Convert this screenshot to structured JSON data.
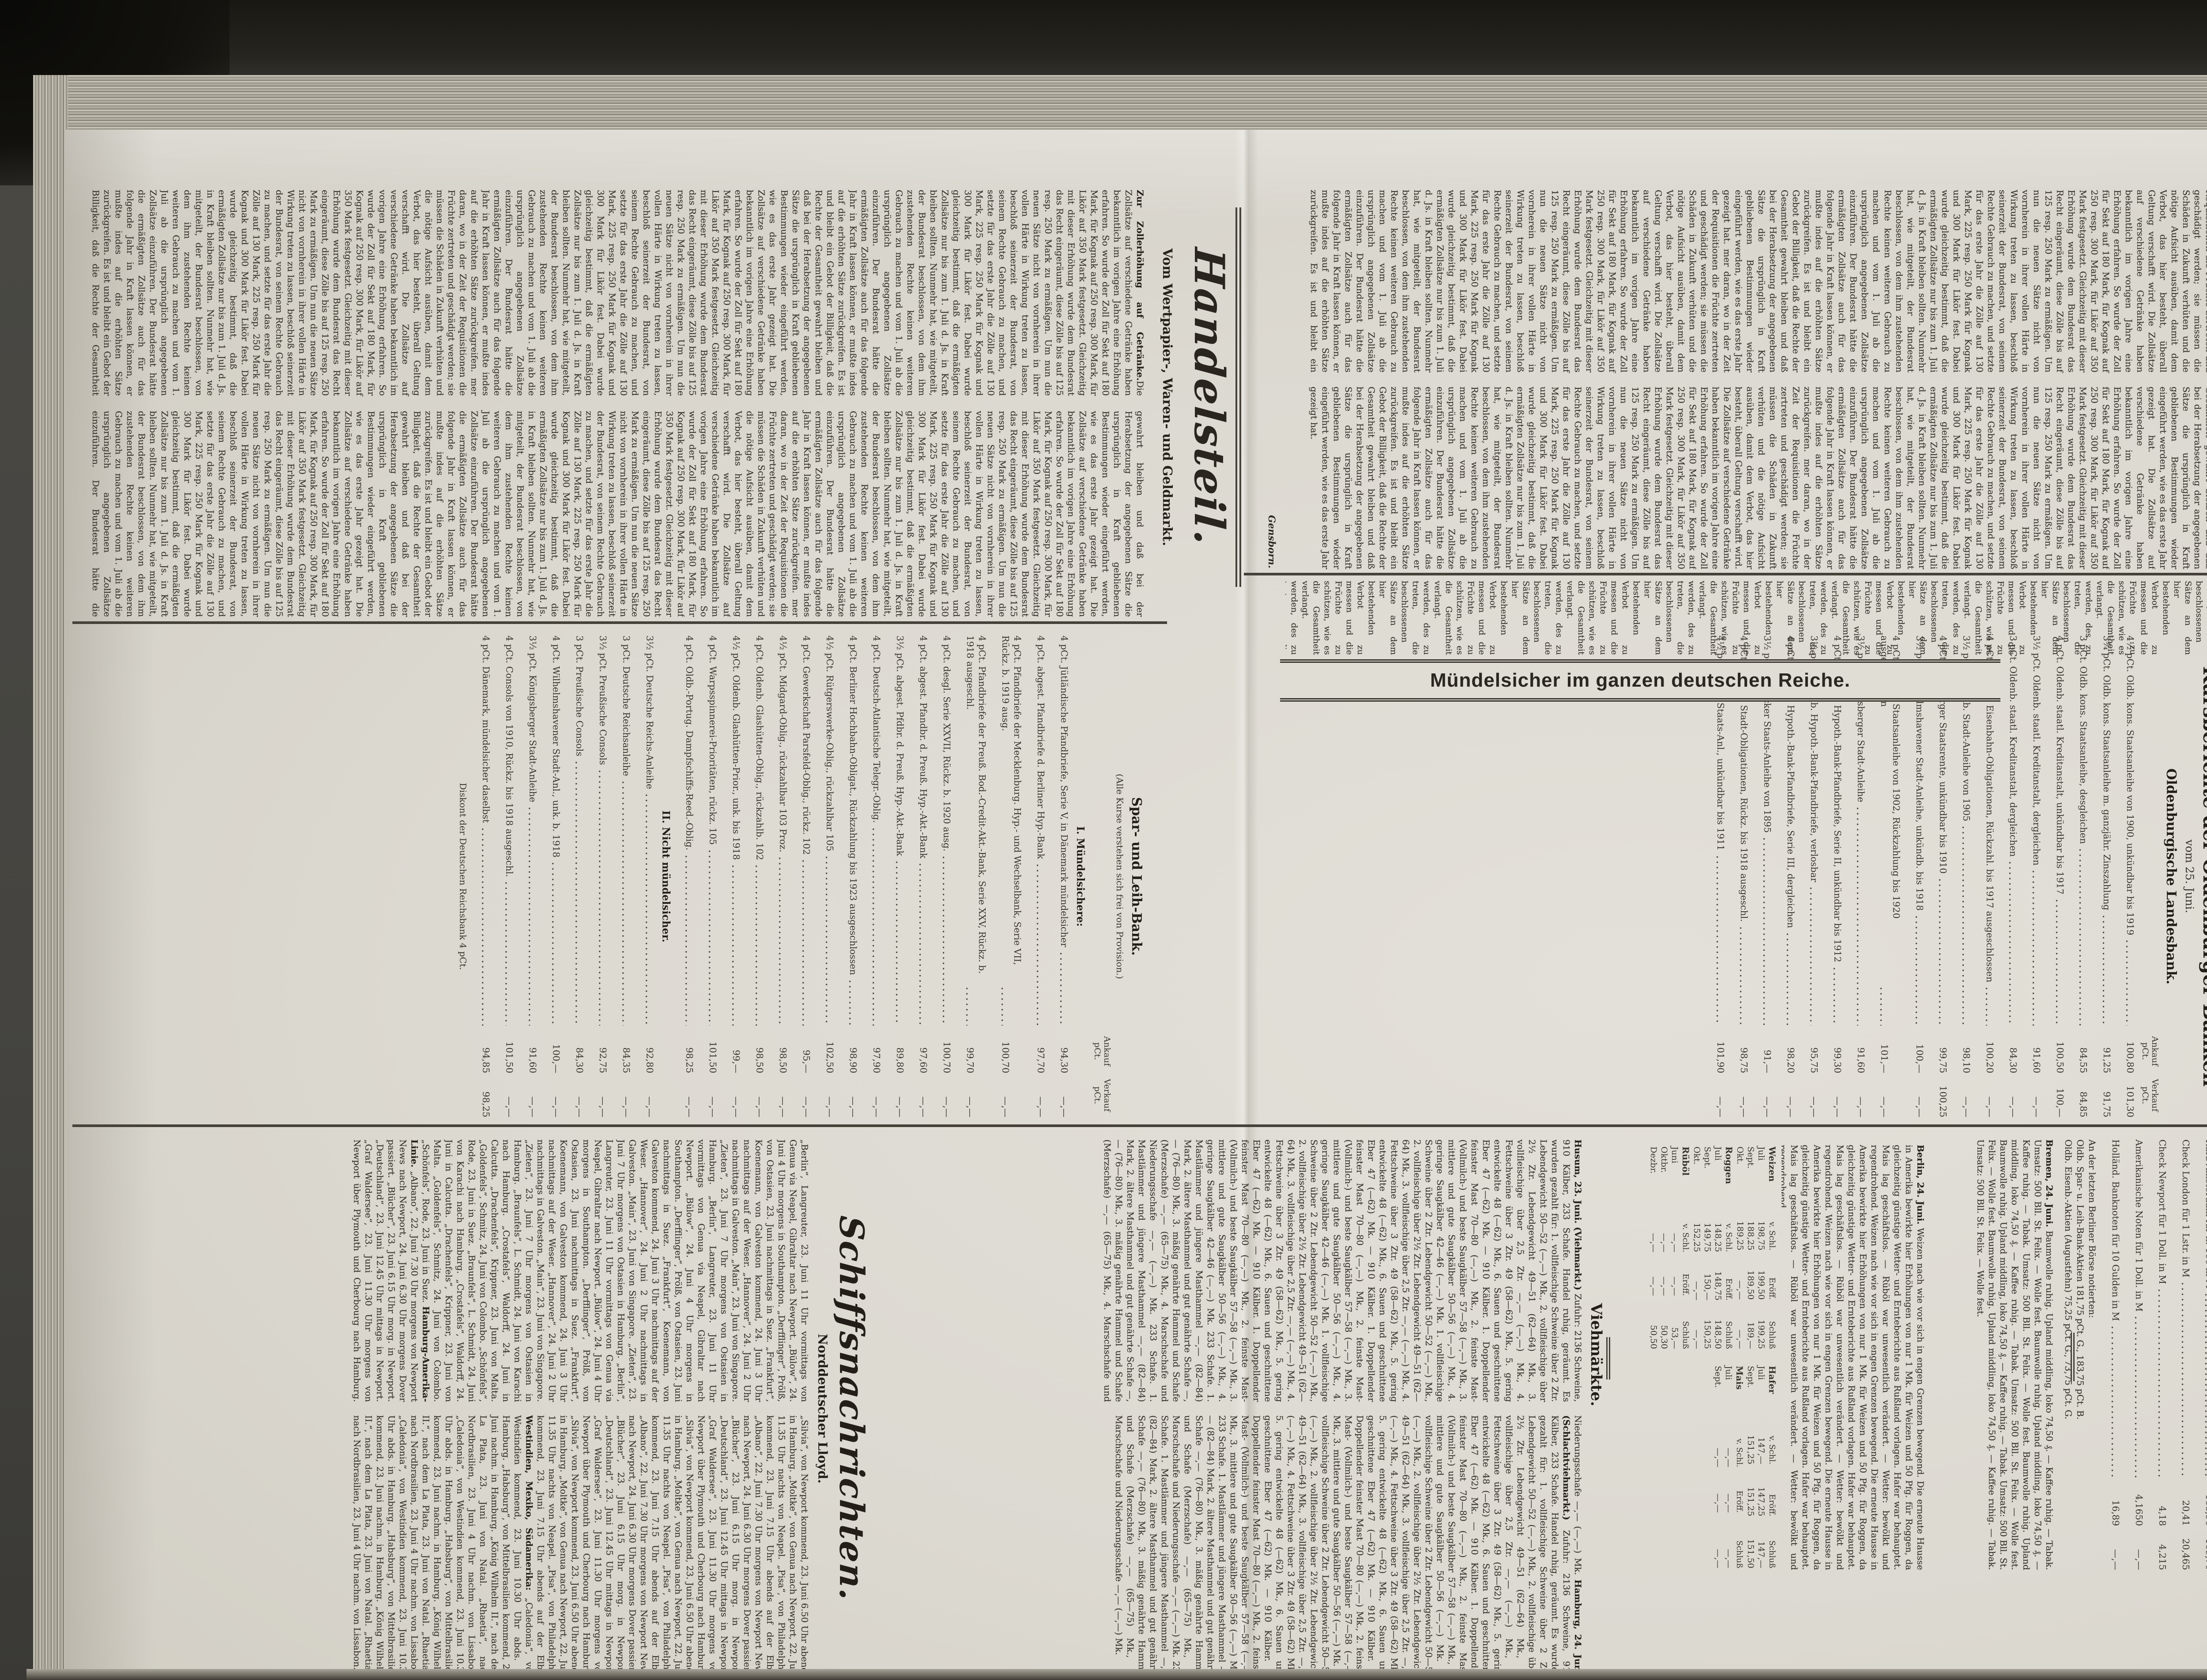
{
  "page": {
    "number_stamp": "1244"
  },
  "colors": {
    "paper": "#dcd9d1",
    "ink": "#39342c",
    "ink_bold": "#262119",
    "rule": "#46423a",
    "bg_dark": "#26251f"
  },
  "fill": {
    "req": "mer daran, wo in der Zeit der Requisitionen die Früchte zertreten und geschädigt werden; sie müssen die Schäden in Zukunft verhüten und die nötige Aufsicht ausüben, damit dem Verbot, das hier besteht, überall Geltung verschafft wird. ",
    "tariff": "Die Zollsätze auf verschiedene Getränke haben bekanntlich im vorigen Jahre eine Erhöhung erfahren. So wurde der Zoll für Sekt auf 180 Mark, für Kognak auf 250 resp. 300 Mark, für Likör auf 350 Mark festgesetzt. Gleichzeitig mit dieser Erhöhung wurde dem Bundesrat das Recht eingeräumt, diese Zölle bis auf 125 resp. 250 Mark zu ermäßigen. Um nun die neuen Sätze nicht von vornherein in ihrer vollen Härte in Wirkung treten zu lassen, beschloß seinerzeit der Bundesrat, von seinem Rechte Gebrauch zu machen, und setzte für das erste Jahr die Zölle auf 130 Mark, 225 resp. 250 Mark für Kognak und 300 Mark für Likör fest. Dabei wurde gleichzeitig bestimmt, daß die ermäßigten Zollsätze nur bis zum 1. Juli d. Js. in Kraft bleiben sollten. Nunmehr hat, wie mitgeteilt, der Bundesrat beschlossen, von dem ihm zustehenden Rechte keinen weiteren Gebrauch zu machen und vom 1. Juli ab die ursprünglich angegebenen Zollsätze einzuführen. Der Bundesrat hätte die ermäßigten Zollsätze auch für das folgende Jahr in Kraft lassen können, er mußte indes auf die erhöhten Sätze zurückgreifen. ",
    "forest": "Es ist und bleibt ein Gebot der Billigkeit, daß die Rechte der Gesamtheit gewahrt bleiben und daß bei der Herabsetzung der angegebenen Sätze die ursprünglich in Kraft gebliebenen Bestimmungen wieder eingeführt werden, wie es das erste Jahr gezeigt hat. ",
    "narrow": "werden, des zu treten, die beschlossenen Sätze an dem hier bestehenden Verbot zu messen und die Früchte zu schützen, wie es die Gesamtheit verlangt. "
  },
  "news": {
    "article_end": {
      "segments": [
        {
          "ref": "fill.req"
        },
        {
          "ref": "fill.tariff"
        },
        {
          "ref": "fill.forest"
        },
        {
          "ref": "fill.req"
        },
        {
          "ref": "fill.tariff"
        },
        {
          "ref": "fill.forest"
        },
        {
          "ref": "fill.tariff"
        },
        {
          "ref": "fill.req"
        },
        {
          "ref": "fill.tariff"
        },
        {
          "ref": "fill.forest"
        }
      ],
      "signature": "Gensborn."
    },
    "narrow_col": {
      "segments": [
        {
          "ref": "fill.narrow",
          "r": 8
        }
      ]
    },
    "handelsteil": {
      "title": "Handelsteil.",
      "subtitle": "Vom Wertpapier-, Waren- und Geldmarkt.",
      "lead": "Zur Zollerhöhung auf Getränke.",
      "segments": [
        {
          "ref": "fill.tariff"
        },
        {
          "ref": "fill.forest"
        },
        {
          "ref": "fill.tariff"
        },
        {
          "ref": "fill.req"
        },
        {
          "ref": "fill.tariff"
        },
        {
          "ref": "fill.forest"
        },
        {
          "ref": "fill.tariff"
        },
        {
          "ref": "fill.req"
        },
        {
          "ref": "fill.tariff"
        },
        {
          "ref": "fill.forest"
        },
        {
          "ref": "fill.tariff"
        }
      ]
    }
  },
  "ad_banner": {
    "text": "Mündelsicher im ganzen deutschen Reiche."
  },
  "kursberichte": {
    "title": "Kursberichte der Oldenburger Banken",
    "date": "vom 25. Juni.",
    "col_a": "Ankauf",
    "col_b": "Verkauf",
    "unit": "pCt.",
    "landesbank": {
      "name": "Oldenburgische Landesbank.",
      "rows": [
        {
          "n": "4½ pCt. Oldb. kons. Staatsanleihe von 1900, unkündbar bis 1919",
          "a": "100,80",
          "v": "101,30"
        },
        {
          "n": "3¾ pCt. Oldb. kons. Staatsanleihe m. ganzjähr. Zinszahlung",
          "a": "91,25",
          "v": "91,75"
        },
        {
          "n": "3 pCt. Oldb. kons. Staatsanleihe, desgleichen",
          "a": "84,55",
          "v": "84,85"
        },
        {
          "n": "4 pCt. Oldenb. staatl. Kreditanstalt, unkündbar bis 1917",
          "a": "100,50",
          "v": "100,—"
        },
        {
          "n": "3½ pCt. Oldenb. staatl. Kreditanstalt, dergleichen",
          "a": "91,60",
          "v": "—,—"
        },
        {
          "n": "3 pCt. Oldenb. staatl. Kreditanstalt, dergleichen",
          "a": "84,30",
          "v": "—,—"
        },
        {
          "n": "4 pCt. Oldenb. Eisenbahn-Obligationen, Rückzahl. bis 1917 ausgeschlossen",
          "a": "100,20",
          "v": "—,—"
        },
        {
          "n": "3½ pCt. Oldenb. Stadt-Anleihe von 1905",
          "a": "98,10",
          "v": "—,—"
        },
        {
          "n": "4 pCt. Hamburger Staatsrente, unkündbar bis 1910",
          "a": "99,75",
          "v": "100,25"
        },
        {
          "n": "3½ pCt. Wilhelmshavener Stadt-Anleihe, unkündb. bis 1918",
          "a": "100,—",
          "v": "—,—"
        },
        {
          "n": "4 pCt. Bremer Staatsanleihe von 1902, Rückzahlung bis 1920 ausgeschlossen",
          "a": "101,—",
          "v": "—,—"
        },
        {
          "n": "3½ pCt. Königsberger Stadt-Anleihe",
          "a": "91,60",
          "v": "—,—"
        },
        {
          "n": "4 pCt. Oldenb. Hypoth.-Bank-Pfandbriefe, Serie II, unkündbar bis 1912",
          "a": "99,30",
          "v": "—,—"
        },
        {
          "n": "3½ pCt. Oldenb. Hypoth.-Bank-Pfandbriefe, verlosbar",
          "a": "95,75",
          "v": "—,—"
        },
        {
          "n": "4 pCt. Oldenb. Hypoth.-Bank-Pfandbriefe, Serie III, dergleichen",
          "a": "98,20",
          "v": "—,—"
        },
        {
          "n": "3½ pCt. Lübecker Staats-Anleihe von 1895",
          "a": "91,—",
          "v": "—,—"
        },
        {
          "n": "4 pCt. Oldenb. Stadt-Obligationen, Rückz. bis 1918 ausgeschl.",
          "a": "98,75",
          "v": "—,—"
        },
        {
          "n": "4½ pCt. Oldb. Staats-Anl., unkündbar bis 1911",
          "a": "101,90",
          "v": "—,—"
        }
      ]
    },
    "sparleih": {
      "name": "Spar- und Leih-Bank.",
      "note": "(Alle Kurse verstehen sich frei von Provision.)",
      "group1": "I. Mündelsichere:",
      "rows1": [
        {
          "n": "4 pCt. Jütländische Pfandbriefe, Serie V, in Dänemark mündelsicher",
          "a": "94,30",
          "v": "—,—"
        },
        {
          "n": "4 pCt. abgest. Pfandbriefe d. Berliner Hyp.-Bank",
          "a": "97,70",
          "v": "—,—"
        },
        {
          "n": "4 pCt. Pfandbriefe der Mecklenburg. Hyp.- und Wechselbank, Serie VII, Rückz. b. 1919 ausg.",
          "a": "100,70",
          "v": "—,—"
        },
        {
          "n": "4 pCt. Pfandbriefe der Preuß. Bod.-Credit-Akt.-Bank, Serie XXV, Rückz. b. 1918 ausgeschl.",
          "a": "99,70",
          "v": "—,—"
        },
        {
          "n": "4 pCt. desgl. Serie XXVII, Rückz. b. 1920 ausg.",
          "a": "100,70",
          "v": "—,—"
        },
        {
          "n": "4 pCt. abgest. Pfandbr. d. Preuß. Hyp.-Akt.-Bank",
          "a": "97,60",
          "v": "—,—"
        },
        {
          "n": "3½ pCt. abgest. Pfdbr. d. Preuß. Hyp.-Akt.-Bank",
          "a": "89,80",
          "v": "—,—"
        },
        {
          "n": "4 pCt. Deutsch-Atlantische Telegr.-Oblig.",
          "a": "97,90",
          "v": "—,—"
        },
        {
          "n": "4 pCt. Berliner Hochbahn-Obligat., Rückzahlung bis 1923 ausgeschlossen",
          "a": "98,90",
          "v": "—,—"
        },
        {
          "n": "4½ pCt. Rütgerswerke-Oblig., rückzahlbar 105",
          "a": "102,50",
          "v": "—,—"
        },
        {
          "n": "4 pCt. Gewerkschaft Parsfeld-Oblig., rückz. 102",
          "a": "95,—",
          "v": "—,—"
        },
        {
          "n": "4½ pCt. Midgard-Oblig., rückzahlbar 103 Proz.",
          "a": "98,50",
          "v": "—,—"
        },
        {
          "n": "4 pCt. Oldenb. Glashütten-Oblig., rückzahlb. 102",
          "a": "98,50",
          "v": "—,—"
        },
        {
          "n": "4½ pCt. Oldenb. Glashütten-Prior., unk. bis 1918",
          "a": "99,—",
          "v": "—,—"
        },
        {
          "n": "4 pCt. Warpsspinnerei-Prioritäten, rückz. 105",
          "a": "101,50",
          "v": "—,—"
        },
        {
          "n": "4 pCt. Oldb.-Portug. Dampfschiffs-Reed.-Oblig.",
          "a": "98,25",
          "v": "—,—"
        }
      ],
      "group2": "II. Nicht mündelsicher.",
      "rows2": [
        {
          "n": "3½ pCt. Deutsche Reichs-Anleihe",
          "a": "92,80",
          "v": "—,—"
        },
        {
          "n": "3 pCt. Deutsche Reichsanleihe",
          "a": "84,35",
          "v": "—,—"
        },
        {
          "n": "3½ pCt. Preußische Consols",
          "a": "92,75",
          "v": "—,—"
        },
        {
          "n": "3 pCt. Preußische Consols",
          "a": "84,30",
          "v": "—,—"
        },
        {
          "n": "4 pCt. Wilhelmshavener Stadt-Anl., unk. b. 1918",
          "a": "100,—",
          "v": "—,—"
        },
        {
          "n": "3½ pCt. Königsberger Stadt-Anleihe",
          "a": "91,60",
          "v": "—,—"
        },
        {
          "n": "4 pCt. Consols von 1910, Rückz. bis 1918 ausgeschl.",
          "a": "101,50",
          "v": "—,—"
        },
        {
          "n": "4 pCt. Dänemark, mündelsicher daselbst",
          "a": "94,85",
          "v": "98,25"
        }
      ],
      "discount_note": "Diskont der Deutschen Reichsbank 4 pCt."
    }
  },
  "exchange": {
    "rows": [
      {
        "n": "Kurz Amsterdam für fl. 100 in M",
        "a": "168,90",
        "v": "169,70"
      },
      {
        "n": "Check London für 1 Lstr. in M",
        "a": "20,41",
        "v": "20,465"
      },
      {
        "n": "Check Newport für 1 Doll. in M",
        "a": "4,18",
        "v": "4,215"
      },
      {
        "n": "Amerikanische Noten für 1 Doll. in M",
        "a": "4,1650",
        "v": "—,—"
      },
      {
        "n": "Holländ. Banknoten für 10 Gulden in M",
        "a": "16,89",
        "v": "—,—"
      }
    ],
    "lines": [
      "An der letzten Berliner Börse notierten:",
      "Oldb. Spar- u. Leih-Bank-Aktien 181,75 pCt. G., 183,75 pCt. B.",
      "Oldb. Eisenb.-Aktien (Augustfehn) 75,25 pCt. G., 73,75 pCt. G."
    ]
  },
  "markets": {
    "bremen": {
      "segments": [
        {
          "b": "Bremen, 24. Juni."
        },
        {
          "t": " Baumwolle ruhig. Upland middling, loko 74,50 ₰. — Kaffee ruhig. — Tabak. Umsatz: 500 Bll. St. Felix. — Wolle fest. ",
          "r": 5
        }
      ]
    },
    "berlin": {
      "segments": [
        {
          "b": "Berlin, 24. Juni."
        },
        {
          "t": " Weizen nach wie vor sich in engen Grenzen bewegend. Die erneute Hausse in Amerika bewirkte hier Erhöhungen von nur 1 Mk. für Weizen und 50 Pfg. für Roggen, da gleichzeitig günstige Wetter- und Ernteberichte aus Rußland vorlagen. Hafer war behauptet. Mais lag geschäftslos. — Rüböl war unwesentlich verändert. — Wetter: bewölkt und regendrohend. ",
          "r": 3
        }
      ]
    },
    "futures": {
      "headers": [
        "v. Schl.",
        "Eröff.",
        "Schluß"
      ],
      "tables": [
        {
          "name": "Weizen",
          "rows": [
            [
              "Juli",
              "198,75",
              "199,50",
              "199,25"
            ],
            [
              "Sept.",
              "188,25",
              "189,50",
              "189,—"
            ],
            [
              "Okt.",
              "189,25",
              "—,—",
              "—,—"
            ]
          ]
        },
        {
          "name": "Hafer",
          "rows": [
            [
              "Juli",
              "147,—",
              "147,25",
              "147,—"
            ],
            [
              "Sept.",
              "151,25",
              "151,25",
              "151,50"
            ]
          ]
        },
        {
          "name": "Roggen",
          "rows": [
            [
              "Juli",
              "148,25",
              "148,75",
              "148,50"
            ],
            [
              "Sept.",
              "149,75",
              "150,—",
              "150,25"
            ],
            [
              "Okt.",
              "152,25",
              "—,—",
              "—,—"
            ]
          ]
        },
        {
          "name": "Mais",
          "rows": [
            [
              "Juli",
              "—,—",
              "—,—",
              "—,—"
            ],
            [
              "Sept.",
              "—,—",
              "—,—",
              "—,—"
            ]
          ]
        },
        {
          "name": "Rüböl",
          "rows": [
            [
              "Juni",
              "—,—",
              "—,—",
              "53,—"
            ],
            [
              "Oktbr.",
              "—,—",
              "—,—",
              "50,30"
            ],
            [
              "Dezbr.",
              "—,—",
              "—,—",
              "50,50"
            ]
          ]
        }
      ]
    },
    "vieh_title": "Viehmärkte.",
    "livestock": {
      "segments": [
        {
          "b": "Husum, 23. Juni. (Viehmarkt.)"
        },
        {
          "t": " Zufuhr: 2136 Schweine, 910 Kälber, 233 Schafe. Handel ruhig, geräumt. Es wurden gezahlt für: "
        },
        {
          "t": " 1. vollfleischige Schweine über 2 Ztr. Lebendgewicht 50—52 (—,—) Mk., 2. vollfleischige über 2½ Ztr. Lebendgewicht 49—51 (62—64) Mk., 3. vollfleischige über 2,5 Ztr. —,— (—,—) Mk., 4. Fettschweine über 3 Ztr. 49 (58—62) Mk., 5. gering entwickelte 48 (—62) Mk., 6. Sauen und geschnittene Eber 47 (—62) Mk. — 910 Kälber. 1. Doppellender feinster Mast 70—80 (—,—) Mk., 2. feinste Mast- (Vollmilch-) und beste Saugkälber 57—58 (—,—) Mk., 3. mittlere und gute Saugkälber 50—56 (—,—) Mk., 4. geringe Saugkälber 42—46 (—,—) Mk. ",
          "r": 3
        },
        {
          "t": " 233 Schafe. 1. Mastlämmer und jüngere Masthammel —,— (82—84) Mark, 2. ältere Masthammel und gut genährte Schafe —,— (76—80) Mk., 3. mäßig genährte Hammel und Schafe (Merzschafe) —,— (65—75) Mk., 4. Marschschafe und Niederungsschafe —,— (—,—) Mk. ",
          "r": 2
        },
        {
          "b": "Hamburg, 24. Juni. (Schlachtviehmarkt.)"
        },
        {
          "t": " Zufuhr: 2136 Schweine, 910 Kälber, 233 Schafe. Handel ruhig, geräumt. Es wurden gezahlt für: "
        },
        {
          "t": " 1. vollfleischige Schweine über 2 Ztr. Lebendgewicht 50—52 (—,—) Mk., 2. vollfleischige über 2½ Ztr. Lebendgewicht 49—51 (62—64) Mk., 3. vollfleischige über 2,5 Ztr. —,— (—,—) Mk., 4. Fettschweine über 3 Ztr. 49 (58—62) Mk., 5. gering entwickelte 48 (—62) Mk., 6. Sauen und geschnittene Eber 47 (—62) Mk. — 910 Kälber. 1. Doppellender feinster Mast 70—80 (—,—) Mk., 2. feinste Mast- (Vollmilch-) und beste Saugkälber 57—58 (—,—) Mk., 3. mittlere und gute Saugkälber 50—56 (—,—) Mk. ",
          "r": 3
        },
        {
          "t": " 233 Schafe. 1. Mastlämmer und jüngere Masthammel —,— (82—84) Mark, 2. ältere Masthammel und gut genährte Schafe —,— (76—80) Mk., 3. mäßig genährte Hammel und Schafe (Merzschafe) —,— (65—75) Mk., 4. Marschschafe und Niederungsschafe —,— (—,—) Mk. ",
          "r": 2
        }
      ]
    }
  },
  "schiff": {
    "title": "Schiffsnachrichten.",
    "lloyd": "Norddeutscher Lloyd.",
    "hapag": "Hamburg-Amerika-Linie.",
    "westindien": "Westindien, Mexiko, Südamerika:",
    "segments_lloyd": [
      {
        "t": " „Berlin“, Langreuter, 23. Juni 11 Uhr vormittags von Genua via Neapel, Gibraltar nach Newport. „Bülow“, 24. Juni 4 Uhr morgens in Southampton. „Derfflinger“, Prölß, von Ostasien, 23. Juni nachmittags in Suez. „Frankfurt“, Koenemann, von Galveston kommend, 24. Juni 3 Uhr nachmittags auf der Weser. „Hannover“, 24. Juni 2 Uhr nachmittags in Galveston. „Main“, 23. Juni von Singapore. „Zieten“, 23. Juni 7 Uhr morgens von Ostasien in Hamburg. ",
        "r": 3
      },
      {
        "t": " „Braunfels“, L. Schmidt, 24. Juni von Karachi nach Hamburg. „Crostafels“, Waldorff, 24. Juni in Calcutta. „Drachenfels“, Krippner, 23. Juni von Malta. „Goldenfels“, Schmitz, 24. Juni von Colombo. „Schönfels“, Rode, 23. Juni in Suez. ",
        "r": 2
      }
    ],
    "segments_na": [
      {
        "t": " „Albano“, 22. Juni 7.30 Uhr morgens von Newport News nach Newport, 24. Juni 6.30 Uhr morgens Dover passiert. „Blücher“, 23. Juni 6.15 Uhr morg. in Newport. „Deutschland“, 23. Juni 12.45 Uhr mittags in Newport. „Graf Waldersee“, 23. Juni 11.30 Uhr morgens von Newport über Plymouth und Cherbourg nach Hamburg. „Silvia“, von Newport kommend, 23. Juni 6.50 Uhr abends in Hamburg. „Moltke“, von Genua nach Newport, 22. Juni 11.35 Uhr nachts von Neapel. „Pisa“, von Philadelphia kommend, 23. Juni 7.15 Uhr abends auf der Elbe. ",
        "r": 3
      }
    ],
    "segments_wi": [
      {
        "t": " „Caledonia“, von Westindien kommend, 23. Juni 10.30 Uhr abds. in Hamburg. „Habsburg“, von Mittelbrasilien kommend, 23. Juni nachm. in Hamburg. „König Wilhelm II.“, nach dem La Plata, 23. Juni von Natal. „Rhaetia“, nach Nordbrasilien, 23. Juni 4 Uhr nachm. von Lissabon. ",
        "r": 3
      }
    ]
  }
}
